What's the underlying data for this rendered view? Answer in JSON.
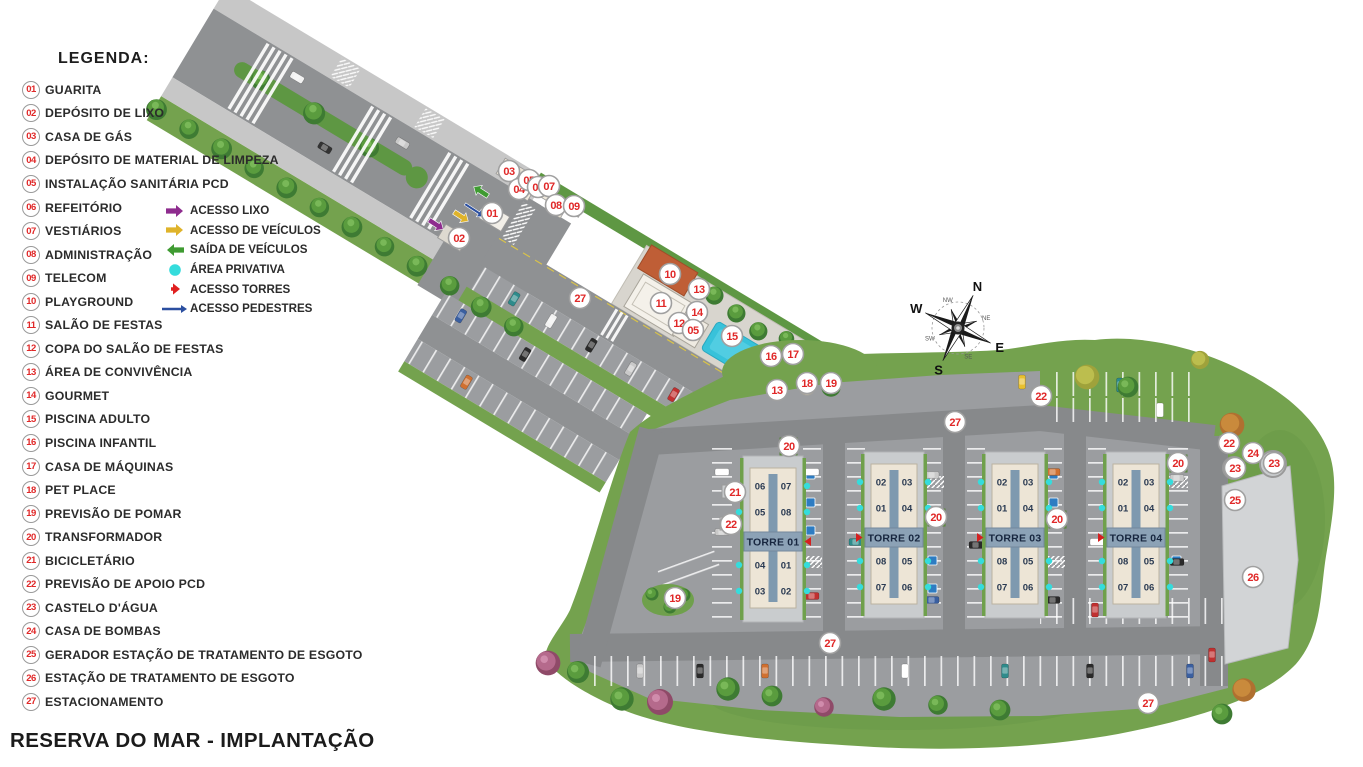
{
  "title": "RESERVA DO MAR - IMPLANTAÇÃO",
  "legend": {
    "heading": "LEGENDA:",
    "items": [
      {
        "num": "01",
        "label": "GUARITA"
      },
      {
        "num": "02",
        "label": "DEPÓSITO DE LIXO"
      },
      {
        "num": "03",
        "label": "CASA DE GÁS"
      },
      {
        "num": "04",
        "label": "DEPÓSITO DE MATERIAL DE LIMPEZA"
      },
      {
        "num": "05",
        "label": "INSTALAÇÃO SANITÁRIA PCD"
      },
      {
        "num": "06",
        "label": "REFEITÓRIO"
      },
      {
        "num": "07",
        "label": "VESTIÁRIOS"
      },
      {
        "num": "08",
        "label": "ADMINISTRAÇÃO"
      },
      {
        "num": "09",
        "label": "TELECOM"
      },
      {
        "num": "10",
        "label": "PLAYGROUND"
      },
      {
        "num": "11",
        "label": "SALÃO DE FESTAS"
      },
      {
        "num": "12",
        "label": "COPA DO SALÃO DE FESTAS"
      },
      {
        "num": "13",
        "label": "ÁREA DE CONVIVÊNCIA"
      },
      {
        "num": "14",
        "label": "GOURMET"
      },
      {
        "num": "15",
        "label": "PISCINA ADULTO"
      },
      {
        "num": "16",
        "label": "PISCINA INFANTIL"
      },
      {
        "num": "17",
        "label": "CASA DE MÁQUINAS"
      },
      {
        "num": "18",
        "label": "PET PLACE"
      },
      {
        "num": "19",
        "label": "PREVISÃO DE POMAR"
      },
      {
        "num": "20",
        "label": "TRANSFORMADOR"
      },
      {
        "num": "21",
        "label": "BICICLETÁRIO"
      },
      {
        "num": "22",
        "label": "PREVISÃO DE APOIO PCD"
      },
      {
        "num": "23",
        "label": "CASTELO D'ÁGUA"
      },
      {
        "num": "24",
        "label": "CASA DE BOMBAS"
      },
      {
        "num": "25",
        "label": "GERADOR ESTAÇÃO DE TRATAMENTO DE ESGOTO"
      },
      {
        "num": "26",
        "label": "ESTAÇÃO DE TRATAMENTO DE ESGOTO"
      },
      {
        "num": "27",
        "label": "ESTACIONAMENTO"
      }
    ],
    "access_items": [
      {
        "glyph": "arrow-right",
        "color": "#8e2c8e",
        "label": "ACESSO LIXO",
        "name": "acesso-lixo"
      },
      {
        "glyph": "arrow-right",
        "color": "#dfb32a",
        "label": "ACESSO DE VEÍCULOS",
        "name": "acesso-veiculos"
      },
      {
        "glyph": "arrow-left",
        "color": "#3f9b32",
        "label": "SAÍDA DE VEÍCULOS",
        "name": "saida-veiculos"
      },
      {
        "glyph": "dot",
        "color": "#35dcdc",
        "label": "ÁREA PRIVATIVA",
        "name": "area-privativa"
      },
      {
        "glyph": "arrow-small",
        "color": "#e02020",
        "label": "ACESSO TORRES",
        "name": "acesso-torres"
      },
      {
        "glyph": "arrow-long",
        "color": "#2b4fa0",
        "label": "ACESSO PEDESTRES",
        "name": "acesso-pedestres"
      }
    ]
  },
  "map": {
    "towers": [
      {
        "name": "TORRE 01",
        "cx": 773,
        "top": 468,
        "units": [
          [
            "06",
            "07"
          ],
          [
            "05",
            "08"
          ],
          [
            "04",
            "01"
          ],
          [
            "03",
            "02"
          ]
        ],
        "arrow_side": "right"
      },
      {
        "name": "TORRE 02",
        "cx": 894,
        "top": 464,
        "units": [
          [
            "02",
            "03"
          ],
          [
            "01",
            "04"
          ],
          [
            "08",
            "05"
          ],
          [
            "07",
            "06"
          ]
        ],
        "arrow_side": "left"
      },
      {
        "name": "TORRE 03",
        "cx": 1015,
        "top": 464,
        "units": [
          [
            "02",
            "03"
          ],
          [
            "01",
            "04"
          ],
          [
            "08",
            "05"
          ],
          [
            "07",
            "06"
          ]
        ],
        "arrow_side": "left"
      },
      {
        "name": "TORRE 04",
        "cx": 1136,
        "top": 464,
        "units": [
          [
            "02",
            "03"
          ],
          [
            "01",
            "04"
          ],
          [
            "08",
            "05"
          ],
          [
            "07",
            "06"
          ]
        ],
        "arrow_side": "left"
      }
    ],
    "markers": [
      {
        "n": "01",
        "x": 492,
        "y": 213
      },
      {
        "n": "02",
        "x": 459,
        "y": 238
      },
      {
        "n": "03",
        "x": 509,
        "y": 171
      },
      {
        "n": "04",
        "x": 519,
        "y": 189
      },
      {
        "n": "05",
        "x": 529,
        "y": 180
      },
      {
        "n": "06",
        "x": 538,
        "y": 187
      },
      {
        "n": "07",
        "x": 549,
        "y": 186
      },
      {
        "n": "08",
        "x": 556,
        "y": 205
      },
      {
        "n": "09",
        "x": 574,
        "y": 206
      },
      {
        "n": "27",
        "x": 580,
        "y": 298
      },
      {
        "n": "10",
        "x": 670,
        "y": 274
      },
      {
        "n": "13",
        "x": 699,
        "y": 289
      },
      {
        "n": "11",
        "x": 661,
        "y": 303
      },
      {
        "n": "14",
        "x": 697,
        "y": 312
      },
      {
        "n": "12",
        "x": 679,
        "y": 323
      },
      {
        "n": "05",
        "x": 693,
        "y": 330
      },
      {
        "n": "15",
        "x": 732,
        "y": 336
      },
      {
        "n": "16",
        "x": 771,
        "y": 356
      },
      {
        "n": "17",
        "x": 793,
        "y": 354
      },
      {
        "n": "13",
        "x": 777,
        "y": 390
      },
      {
        "n": "18",
        "x": 807,
        "y": 383
      },
      {
        "n": "19",
        "x": 831,
        "y": 383
      },
      {
        "n": "22",
        "x": 1041,
        "y": 396
      },
      {
        "n": "27",
        "x": 955,
        "y": 422
      },
      {
        "n": "20",
        "x": 789,
        "y": 446
      },
      {
        "n": "21",
        "x": 735,
        "y": 492
      },
      {
        "n": "22",
        "x": 731,
        "y": 524
      },
      {
        "n": "19",
        "x": 675,
        "y": 598
      },
      {
        "n": "20",
        "x": 936,
        "y": 517
      },
      {
        "n": "20",
        "x": 1057,
        "y": 519
      },
      {
        "n": "20",
        "x": 1178,
        "y": 463
      },
      {
        "n": "22",
        "x": 1229,
        "y": 443
      },
      {
        "n": "24",
        "x": 1253,
        "y": 453
      },
      {
        "n": "23",
        "x": 1235,
        "y": 468
      },
      {
        "n": "23",
        "x": 1274,
        "y": 463
      },
      {
        "n": "25",
        "x": 1235,
        "y": 500
      },
      {
        "n": "26",
        "x": 1253,
        "y": 577
      },
      {
        "n": "27",
        "x": 830,
        "y": 643
      },
      {
        "n": "27",
        "x": 1148,
        "y": 703
      }
    ],
    "arrows": [
      {
        "name": "acesso-lixo-arrow",
        "color": "#8e2c8e",
        "x": 429,
        "y": 220,
        "angle": 33,
        "len": 17,
        "w": 2.6
      },
      {
        "name": "acesso-veiculos-arrow",
        "color": "#dfb32a",
        "x": 454,
        "y": 212,
        "angle": 33,
        "len": 17,
        "w": 2.6
      },
      {
        "name": "saida-veiculos-arrow",
        "color": "#3f9b32",
        "x": 488,
        "y": 196,
        "angle": 213,
        "len": 17,
        "w": 2.6
      },
      {
        "name": "acesso-pedestres-arrow",
        "color": "#2b4fa0",
        "x": 465,
        "y": 204,
        "angle": 33,
        "len": 23,
        "w": 1.3
      }
    ],
    "compass": {
      "labels_main": [
        "N",
        "E",
        "S",
        "W"
      ],
      "labels_minor": [
        "NE",
        "SE",
        "SW",
        "NW"
      ],
      "rotation_deg": 25,
      "cx": 958,
      "cy": 328
    }
  },
  "colors": {
    "road": "#8f9193",
    "road_dark": "#87898b",
    "sidewalk": "#c7c7c7",
    "grass": "#74a24e",
    "grass_dark": "#5e9743",
    "stall": "#9b9da0",
    "deck": "#d8d5ce",
    "pad": "#c9ccce",
    "concrete": "#d2d4d6",
    "tower_body": "#ede5d6",
    "tower_band": "#8ca2b6",
    "tower_band_text": "#17263f",
    "tower_spine": "#7e99af",
    "pool": "#38c2da",
    "playground": "#bf5e36",
    "marker_red": "#e02828",
    "cyan": "#35dcdc",
    "tower_arrow": "#d42020",
    "blue_parking": "#2e7cc2"
  }
}
